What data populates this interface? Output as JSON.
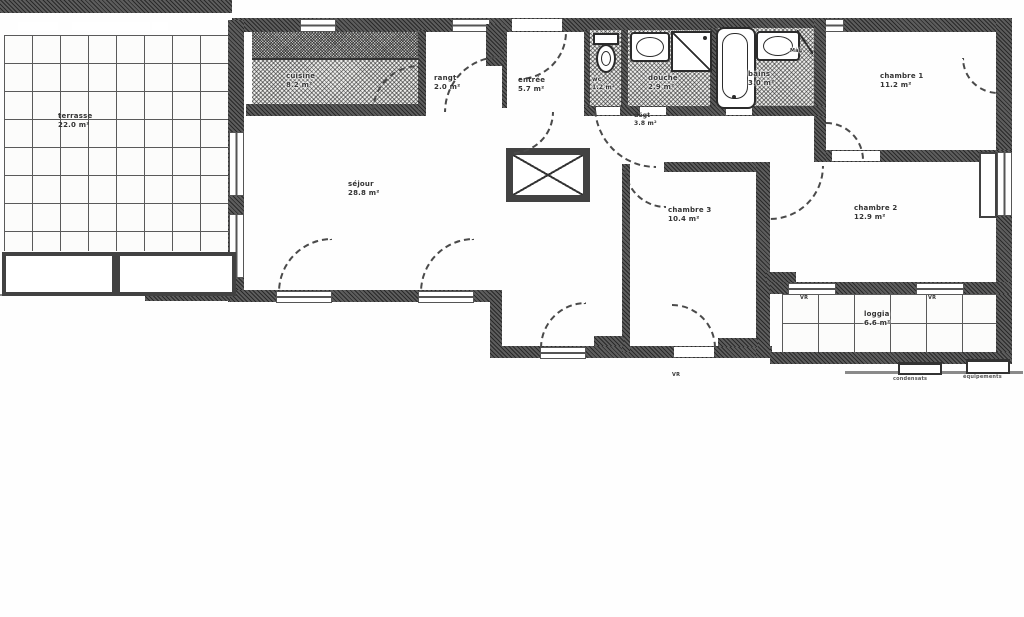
{
  "document": {
    "kind": "scanned apartment floor plan"
  },
  "rooms": [
    {
      "name": "terrasse",
      "area": "22.0 m²"
    },
    {
      "name": "cuisine",
      "area": "8.2 m²"
    },
    {
      "name": "rangt",
      "area": "2.0 m²"
    },
    {
      "name": "entrée",
      "area": "5.7 m²"
    },
    {
      "name": "wc",
      "area": "1.2 m²"
    },
    {
      "name": "douche",
      "area": "2.9 m²"
    },
    {
      "name": "bains",
      "area": "3.0 m²"
    },
    {
      "name": "dégt",
      "area": "3.8 m²"
    },
    {
      "name": "chambre 1",
      "area": "11.2 m²"
    },
    {
      "name": "séjour",
      "area": "28.8 m²"
    },
    {
      "name": "chambre 3",
      "area": "10.4 m²"
    },
    {
      "name": "chambre 2",
      "area": "12.9 m²"
    },
    {
      "name": "loggia",
      "area": "6.6 m²"
    }
  ],
  "annotations": {
    "washing_machine": "MàL",
    "roller_shutter": "VR",
    "equipment_left": "condensats",
    "equipment_right": "équipements"
  },
  "colors": {
    "wall": "#424242",
    "paper": "#fefefe",
    "ink": "#333333"
  }
}
